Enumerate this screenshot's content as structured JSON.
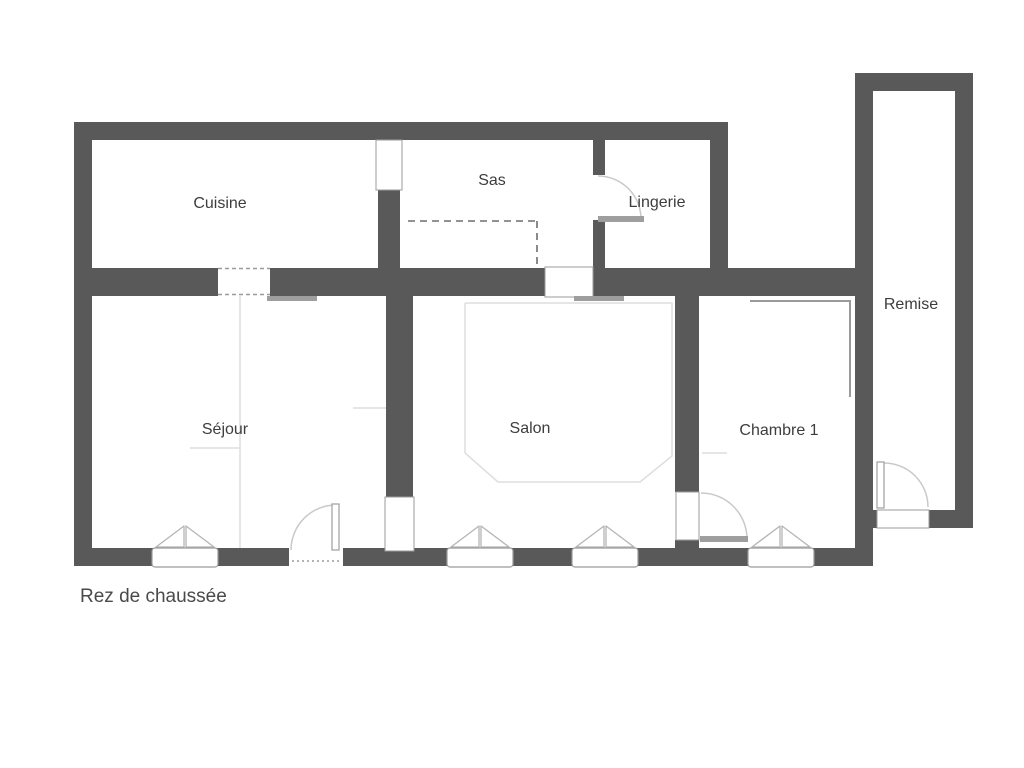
{
  "caption": "Rez de chaussée",
  "labels": {
    "cuisine": "Cuisine",
    "sas": "Sas",
    "lingerie": "Lingerie",
    "remise": "Remise",
    "sejour": "Séjour",
    "salon": "Salon",
    "chambre1": "Chambre 1"
  },
  "colors": {
    "wall": "#595959",
    "opening-border": "#9b9b9b",
    "door": "#9e9e9e",
    "arc": "#c9c9c9",
    "window": "#b5b5b5",
    "faint": "#dedede",
    "thin": "#9a9a9a",
    "dash": "#6e6e6e",
    "label": "#3d3d3d",
    "caption": "#4a4a4a",
    "background": "#ffffff"
  }
}
